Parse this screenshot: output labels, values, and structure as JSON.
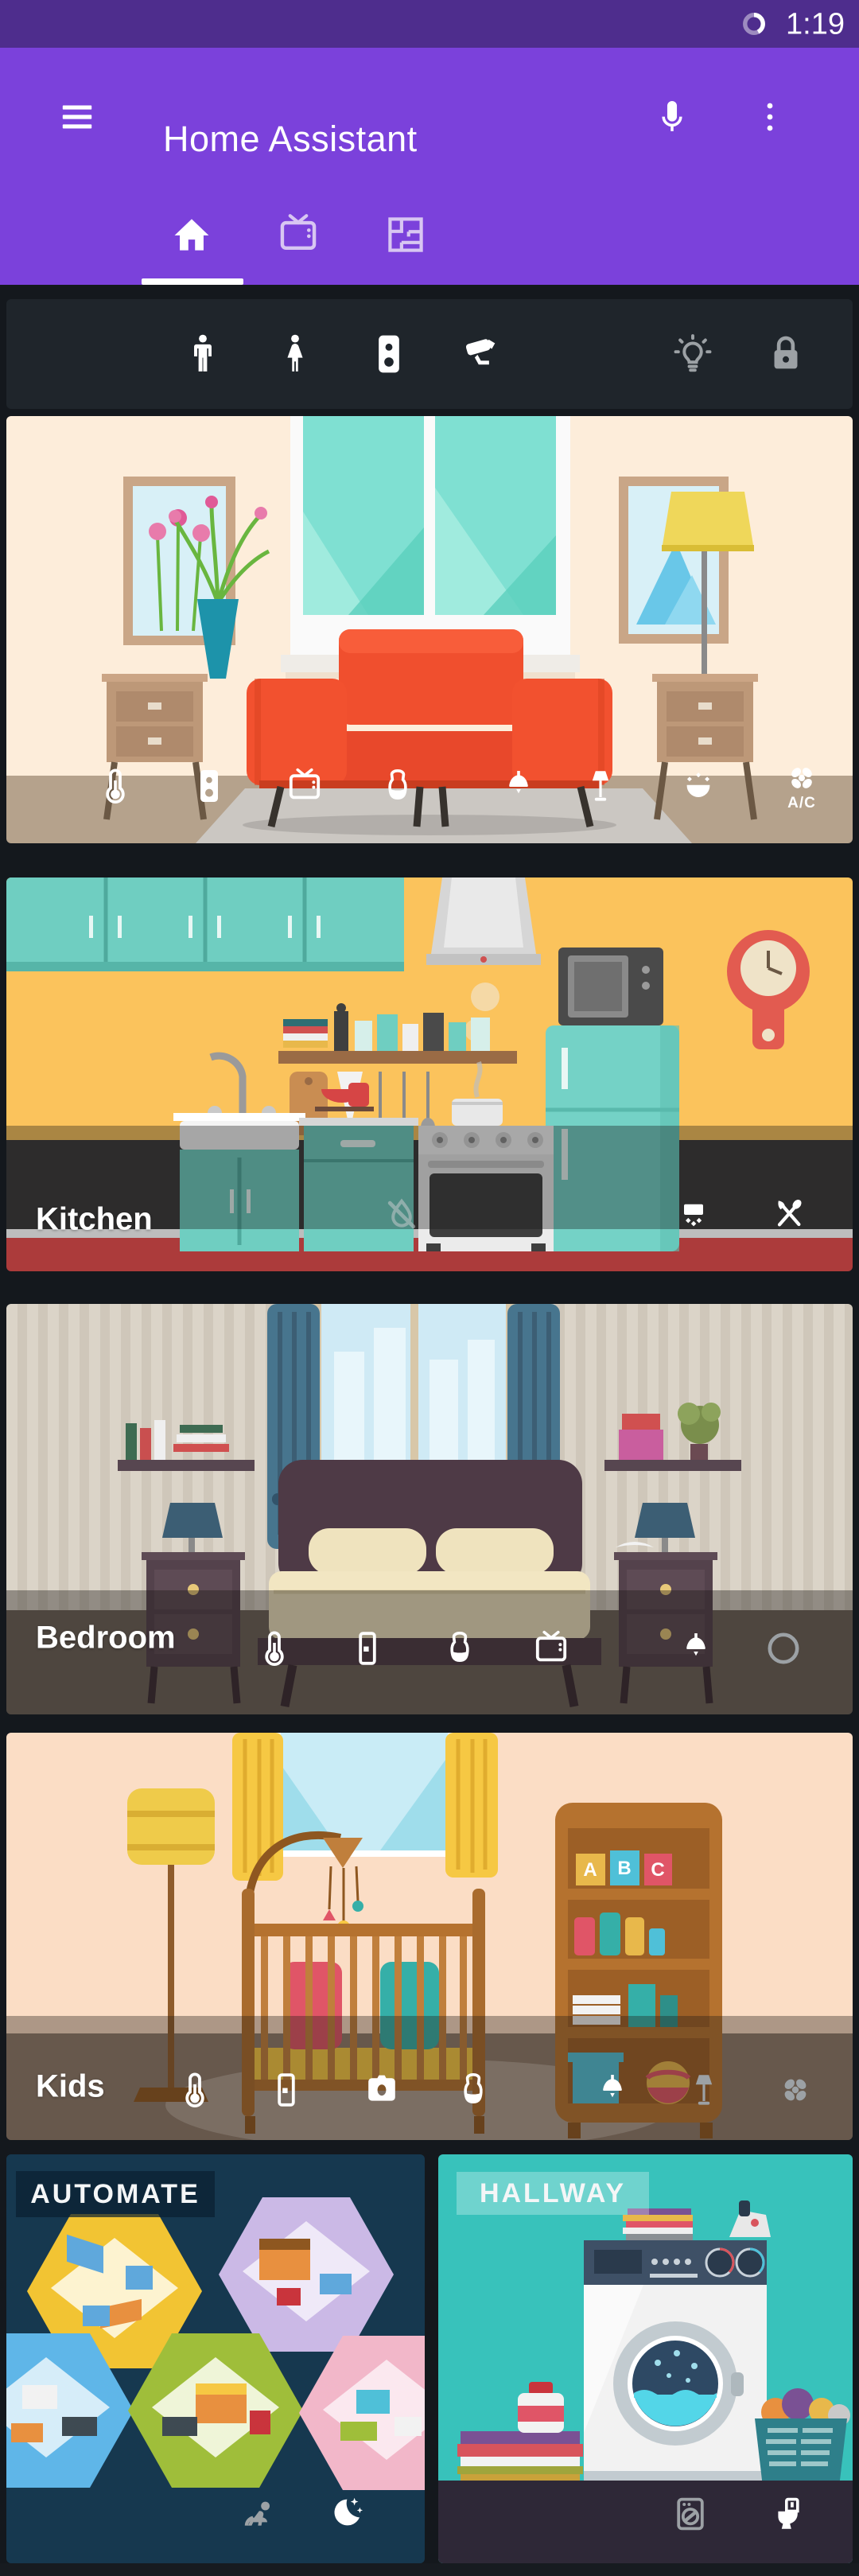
{
  "status_bar": {
    "time": "1:19",
    "icon": "data-saver-icon"
  },
  "app_bar": {
    "title": "Home Assistant",
    "menu_icon": "menu-icon",
    "mic_icon": "microphone-icon",
    "overflow_icon": "overflow-menu-icon"
  },
  "tab_bar": {
    "tabs": [
      {
        "id": "home",
        "icon": "home-icon",
        "selected": true
      },
      {
        "id": "media",
        "icon": "tv-icon",
        "selected": false
      },
      {
        "id": "floorplan",
        "icon": "floorplan-icon",
        "selected": false
      }
    ]
  },
  "entity_toolbar": {
    "icons": [
      {
        "name": "person-male-icon",
        "state": "active"
      },
      {
        "name": "person-female-icon",
        "state": "active"
      },
      {
        "name": "sensor-icon",
        "state": "active"
      },
      {
        "name": "cctv-camera-icon",
        "state": "active"
      },
      {
        "name": "lightbulb-icon",
        "state": "inactive"
      },
      {
        "name": "lock-icon",
        "state": "inactive"
      }
    ]
  },
  "rooms": [
    {
      "id": "living-room",
      "label": "",
      "ac_label": "A/C",
      "icons": [
        "thermometer-icon",
        "sensor-icon",
        "tv-icon",
        "smart-speaker-icon",
        "pendant-light-icon",
        "floor-lamp-icon",
        "sconce-light-icon",
        "ac-fan-icon"
      ]
    },
    {
      "id": "kitchen",
      "label": "Kitchen",
      "icons": [
        "water-off-icon",
        "range-hood-icon",
        "cutlery-icon"
      ]
    },
    {
      "id": "bedroom",
      "label": "Bedroom",
      "icons": [
        "thermometer-icon",
        "door-sensor-icon",
        "smart-speaker-icon",
        "tv-icon",
        "pendant-light-icon",
        "circle-outline-icon"
      ]
    },
    {
      "id": "kids",
      "label": "Kids",
      "blocks_letters": [
        "A",
        "B",
        "C"
      ],
      "icons": [
        "thermometer-icon",
        "door-sensor-icon",
        "camera-icon",
        "smart-speaker-icon",
        "pendant-light-icon",
        "floor-lamp-icon",
        "fan-icon"
      ]
    }
  ],
  "bottom_cards": [
    {
      "id": "automate",
      "label": "AUTOMATE",
      "icons": [
        "baby-icon",
        "night-mode-icon"
      ]
    },
    {
      "id": "hallway",
      "label": "HALLWAY",
      "icons": [
        "washing-machine-icon",
        "toilet-icon"
      ]
    }
  ],
  "colors": {
    "status_bar": "#4E2D8D",
    "app_bar": "#7B41DB",
    "page_bg": "#171B20",
    "toolbar_bg": "#1F252B",
    "icon_active": "#FFFFFF",
    "icon_inactive": "#9CA1A5"
  }
}
